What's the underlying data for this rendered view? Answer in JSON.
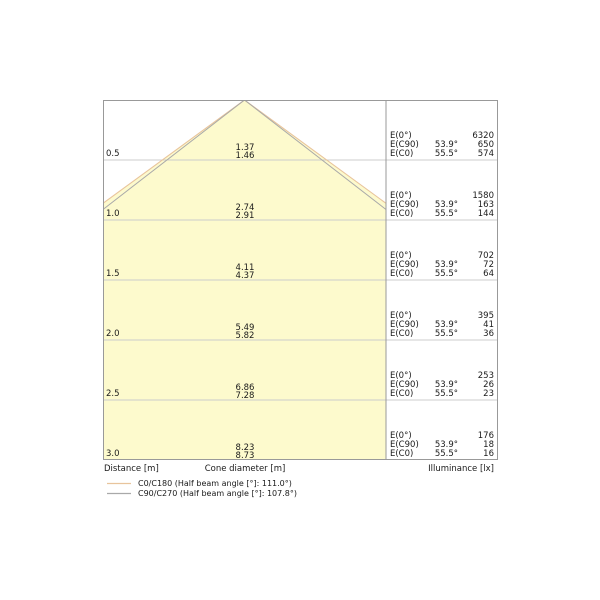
{
  "figure": {
    "axis": {
      "distance_label": "Distance [m]",
      "cone_label": "Cone diameter [m]",
      "illuminance_label": "Illuminance [lx]"
    },
    "e_labels": {
      "e0": "E(0°)",
      "ec90": "E(C90)",
      "ec0": "E(C0)"
    },
    "angles": {
      "c90": "53.9°",
      "c0": "55.5°"
    },
    "rows": [
      {
        "distance": "0.5",
        "cone_c90": "1.37",
        "cone_c0": "1.46",
        "e0": "6320",
        "ec90": "650",
        "ec0": "574"
      },
      {
        "distance": "1.0",
        "cone_c90": "2.74",
        "cone_c0": "2.91",
        "e0": "1580",
        "ec90": "163",
        "ec0": "144"
      },
      {
        "distance": "1.5",
        "cone_c90": "4.11",
        "cone_c0": "4.37",
        "e0": "702",
        "ec90": "72",
        "ec0": "64"
      },
      {
        "distance": "2.0",
        "cone_c90": "5.49",
        "cone_c0": "5.82",
        "e0": "395",
        "ec90": "41",
        "ec0": "36"
      },
      {
        "distance": "2.5",
        "cone_c90": "6.86",
        "cone_c0": "7.28",
        "e0": "253",
        "ec90": "26",
        "ec0": "23"
      },
      {
        "distance": "3.0",
        "cone_c90": "8.23",
        "cone_c0": "8.73",
        "e0": "176",
        "ec90": "18",
        "ec0": "16"
      }
    ],
    "legend": {
      "c0_label": "C0/C180 (Half beam angle [°]: 111.0°)",
      "c90_label": "C90/C270 (Half beam angle [°]: 107.8°)"
    },
    "colors": {
      "cone_fill": "#fdfacd",
      "c0_line": "#e8c49c",
      "c90_line": "#a9a9a9",
      "grid": "#cccccc",
      "border": "#999999"
    }
  },
  "chart_data": {
    "type": "area",
    "title": "Light cone diagram",
    "distance_m": [
      0.5,
      1.0,
      1.5,
      2.0,
      2.5,
      3.0
    ],
    "series": [
      {
        "name": "C0/C180 (Half beam angle [°]: 111.0°)",
        "cone_diameter_m": [
          1.46,
          2.91,
          4.37,
          5.82,
          7.28,
          8.73
        ],
        "color": "#e8c49c"
      },
      {
        "name": "C90/C270 (Half beam angle [°]: 107.8°)",
        "cone_diameter_m": [
          1.37,
          2.74,
          4.11,
          5.49,
          6.86,
          8.23
        ],
        "color": "#a9a9a9"
      }
    ],
    "illuminance_lx": {
      "E(0°)": [
        6320,
        1580,
        702,
        395,
        253,
        176
      ],
      "E(C90) 53.9°": [
        650,
        163,
        72,
        41,
        26,
        18
      ],
      "E(C0) 55.5°": [
        574,
        144,
        64,
        36,
        23,
        16
      ]
    },
    "labels": {
      "x": "Distance [m]",
      "cone": "Cone diameter [m]",
      "illuminance": "Illuminance [lx]"
    },
    "legend_position": "bottom-left",
    "grid": true,
    "ylim_distance_m": [
      0,
      3.0
    ]
  }
}
